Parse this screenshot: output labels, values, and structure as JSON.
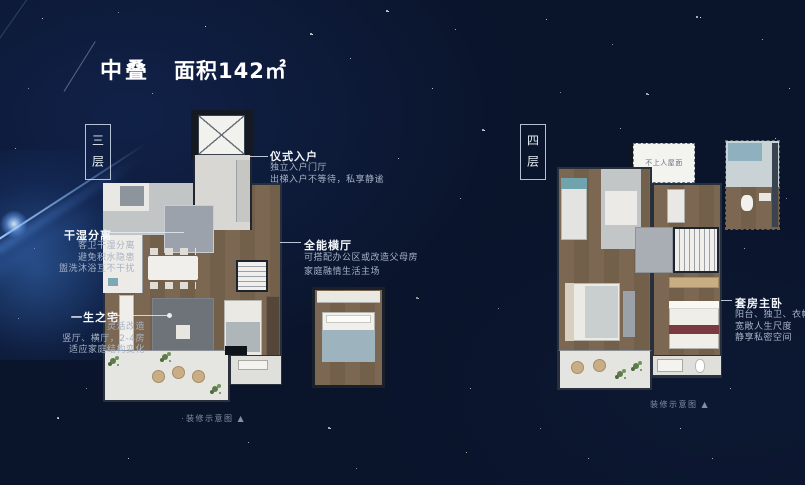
{
  "header": {
    "title": "中叠",
    "area_label": "面积142㎡"
  },
  "floor_left": {
    "label": "三层",
    "caption": "装修示意图 ▲"
  },
  "floor_right": {
    "label": "四层",
    "caption": "装修示意图 ▲",
    "roof_label": "不上人屋面"
  },
  "annotations": {
    "entry": {
      "title": "仪式入户",
      "lines": [
        "独立入户门厅",
        "出梯入户不等待，私享静谧"
      ]
    },
    "drywet": {
      "title": "干湿分离",
      "lines": [
        "客卫干湿分离",
        "避免积水隐患",
        "盥洗沐浴互不干扰"
      ]
    },
    "lifetime": {
      "title": "一生之宅",
      "lines": [
        "灵活改造",
        "竖厅、横厅，2-4房",
        "适应家庭结构变化"
      ]
    },
    "hall": {
      "title": "全能横厅",
      "lines": [
        "可搭配办公区或改造父母房",
        "家庭融情生活主场"
      ]
    },
    "master": {
      "title": "套房主卧",
      "lines": [
        "阳台、独卫、衣帽间",
        "宽敞人生尺度",
        "静享私密空间"
      ]
    }
  },
  "colors": {
    "background": "#0a142b",
    "glow": "#4a8fe0",
    "text_primary": "#ffffff",
    "text_secondary": "#a6b3c7",
    "wood_floor": "#7b6651",
    "balcony": "#e5e5e1"
  }
}
